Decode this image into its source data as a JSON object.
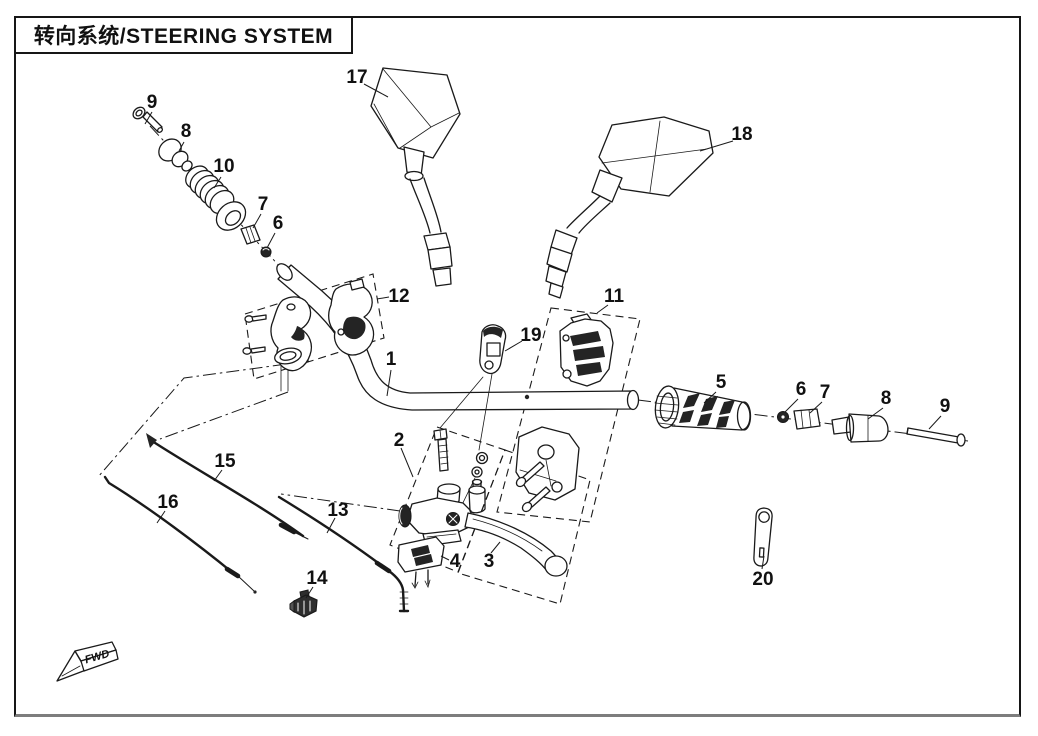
{
  "title": {
    "text": "转向系统/STEERING SYSTEM"
  },
  "drawing": {
    "fwd_label": "FWD",
    "line_color": "#1a1a1a",
    "background_color": "#ffffff"
  },
  "parts": [
    {
      "number": "17",
      "name": "rear-view-mirror-left"
    },
    {
      "number": "18",
      "name": "rear-view-mirror-right"
    },
    {
      "number": "9",
      "name": "bolt-left"
    },
    {
      "number": "8",
      "name": "bar-end-weight-left"
    },
    {
      "number": "10",
      "name": "grip-left"
    },
    {
      "number": "7",
      "name": "sleeve-left"
    },
    {
      "number": "6",
      "name": "nut-left"
    },
    {
      "number": "12",
      "name": "handlebar-clamp"
    },
    {
      "number": "1",
      "name": "handlebar"
    },
    {
      "number": "19",
      "name": "cable-guide-clamp"
    },
    {
      "number": "11",
      "name": "switch-housing-assembly"
    },
    {
      "number": "5",
      "name": "grip-right"
    },
    {
      "number": "6",
      "name": "nut-right"
    },
    {
      "number": "7",
      "name": "sleeve-right"
    },
    {
      "number": "8",
      "name": "bar-end-weight-right"
    },
    {
      "number": "9",
      "name": "bolt-right"
    },
    {
      "number": "2",
      "name": "lever-holder-assembly"
    },
    {
      "number": "3",
      "name": "lever"
    },
    {
      "number": "4",
      "name": "switch"
    },
    {
      "number": "13",
      "name": "cable-13"
    },
    {
      "number": "15",
      "name": "cable-15"
    },
    {
      "number": "16",
      "name": "cable-16"
    },
    {
      "number": "14",
      "name": "connector-14"
    },
    {
      "number": "20",
      "name": "pin-20"
    }
  ]
}
